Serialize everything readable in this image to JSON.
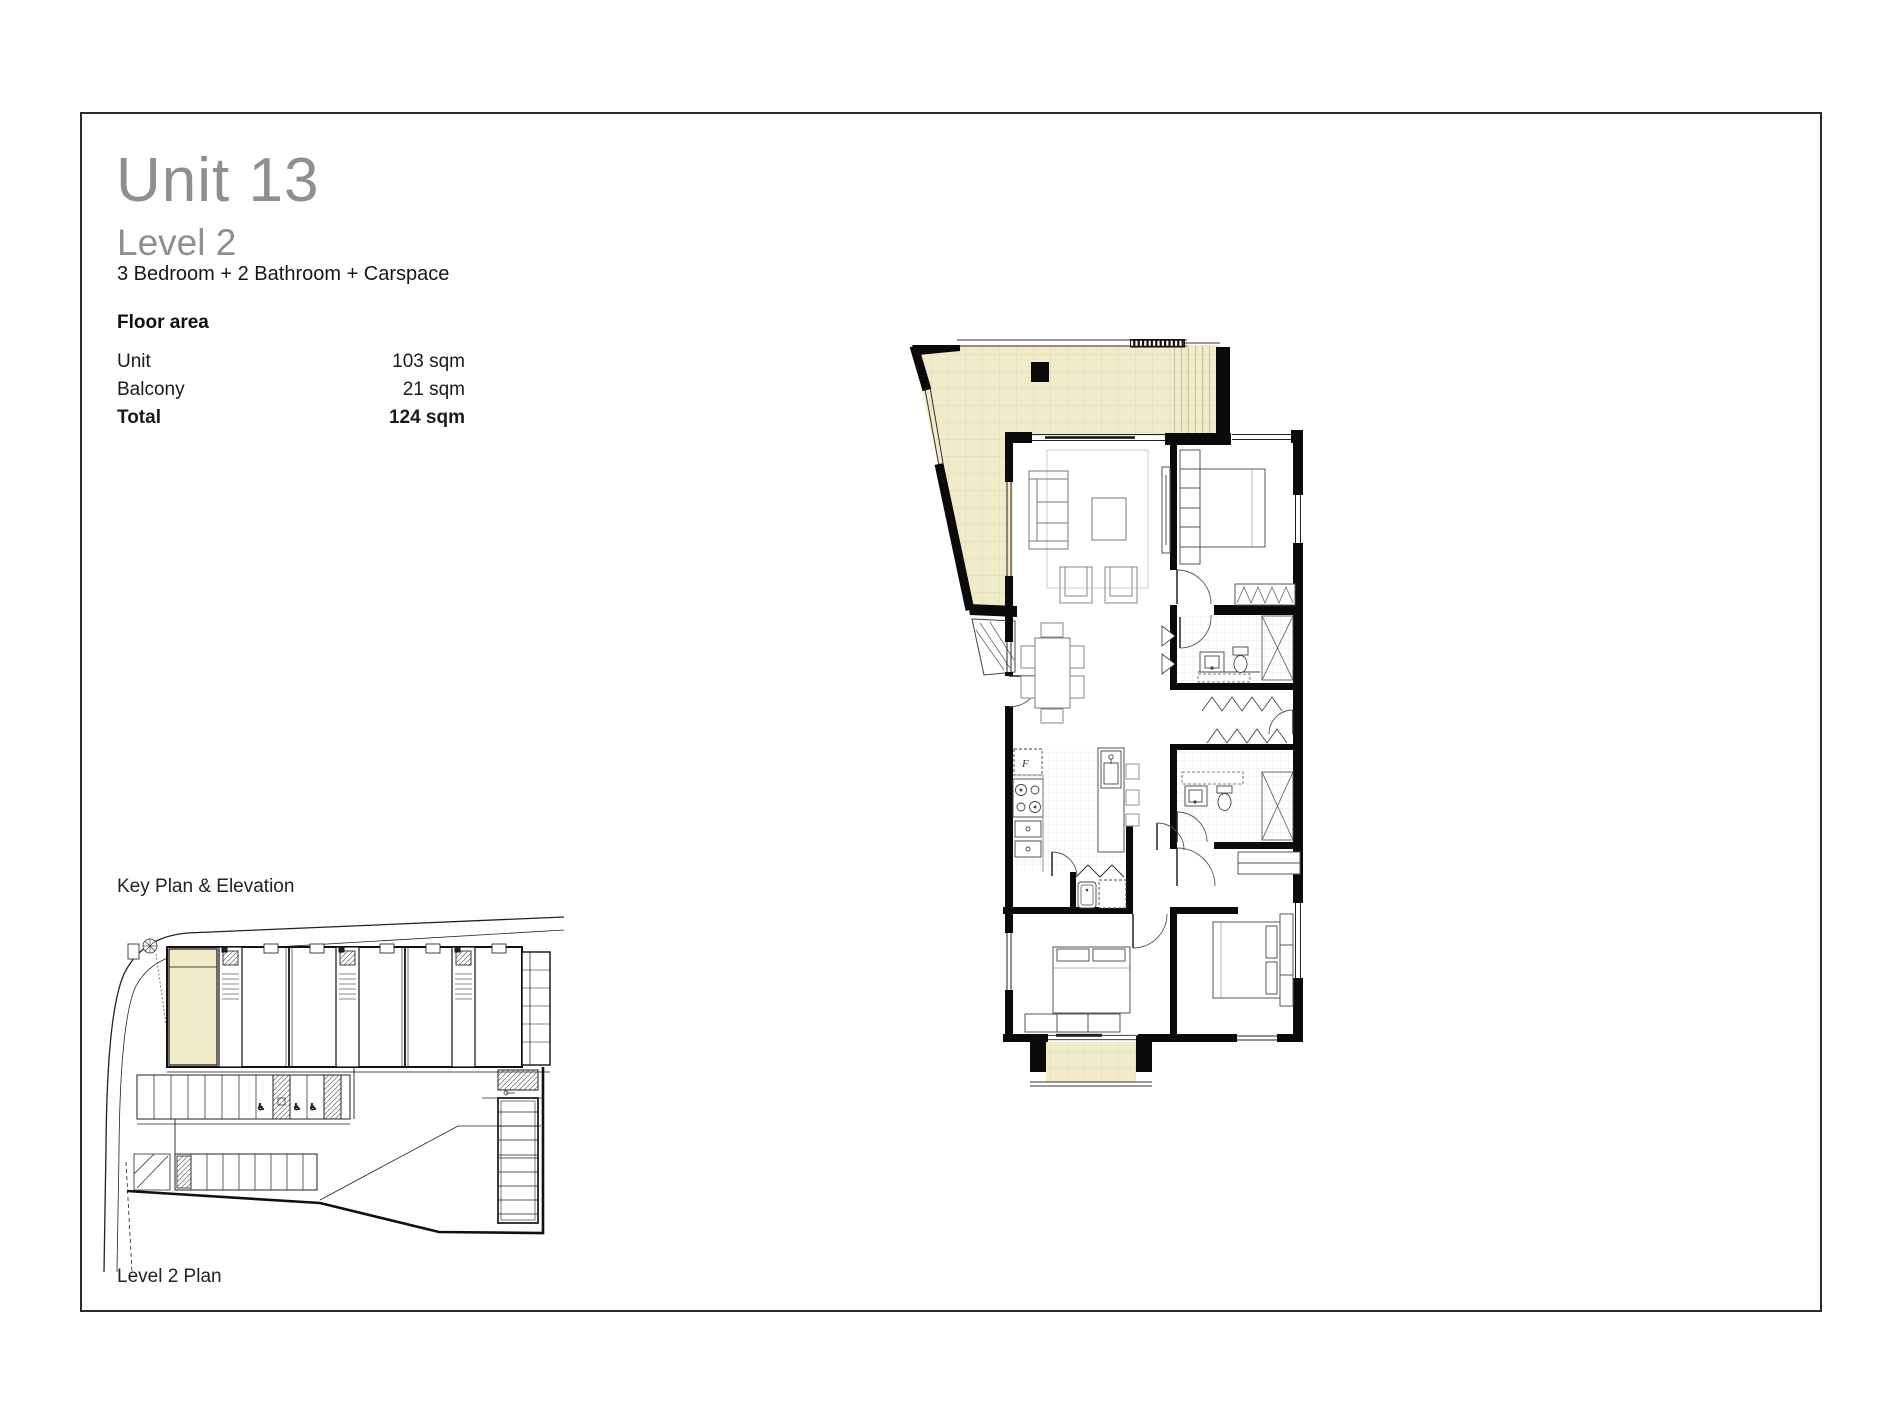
{
  "header": {
    "title": "Unit 13",
    "subtitle": "Level 2",
    "description": "3 Bedroom + 2 Bathroom + Carspace"
  },
  "floor_area": {
    "heading": "Floor area",
    "rows": [
      {
        "label": "Unit",
        "value": "103 sqm"
      },
      {
        "label": "Balcony",
        "value": "21 sqm"
      },
      {
        "label": "Total",
        "value": "124 sqm"
      }
    ]
  },
  "key_plan": {
    "label": "Key Plan & Elevation"
  },
  "footer": {
    "level_plan_label": "Level 2 Plan"
  },
  "plan": {
    "fridge_label": "F"
  },
  "colors": {
    "balcony_fill": "#F1EBC9",
    "balcony_grid": "#DCD4A6",
    "wall": "#0A0A0A",
    "title_gray": "#8F8F8F"
  }
}
